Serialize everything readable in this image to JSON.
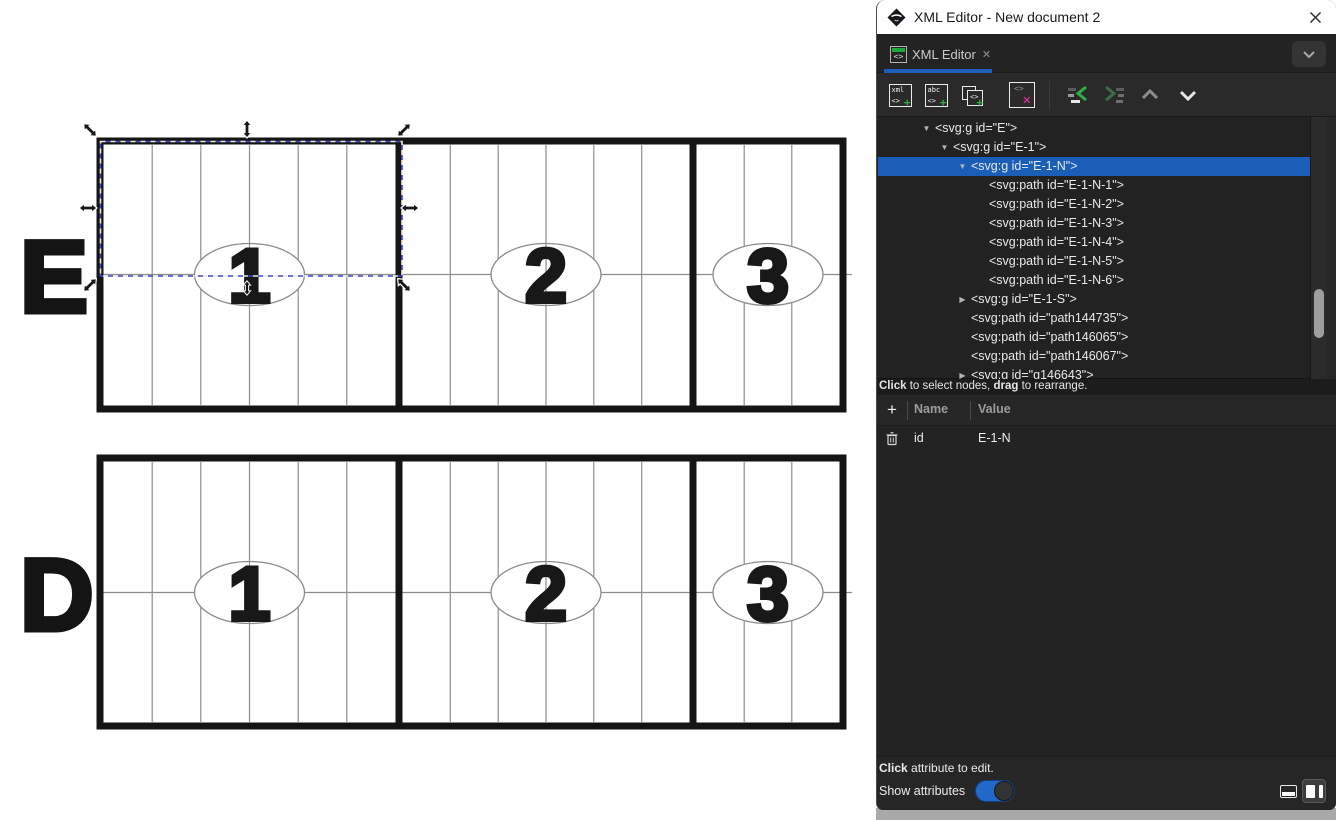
{
  "window": {
    "title": "XML Editor - New document 2"
  },
  "tab": {
    "label": "XML Editor",
    "close_glyph": "✕"
  },
  "icons": {
    "tag": "<>",
    "xml_label": "xml",
    "abc_label": "abc",
    "plus": "+",
    "delete_x": "✕",
    "expander_open": "▼",
    "expander_closed": "▶",
    "add_attribute": "+"
  },
  "xml_tree": {
    "rows": [
      {
        "depth": 0,
        "expander": "open",
        "text": "<svg:g id=\"E\">",
        "selected": false
      },
      {
        "depth": 1,
        "expander": "open",
        "text": "<svg:g id=\"E-1\">",
        "selected": false
      },
      {
        "depth": 2,
        "expander": "open",
        "text": "<svg:g id=\"E-1-N\">",
        "selected": true
      },
      {
        "depth": 3,
        "expander": null,
        "text": "<svg:path id=\"E-1-N-1\">",
        "selected": false
      },
      {
        "depth": 3,
        "expander": null,
        "text": "<svg:path id=\"E-1-N-2\">",
        "selected": false
      },
      {
        "depth": 3,
        "expander": null,
        "text": "<svg:path id=\"E-1-N-3\">",
        "selected": false
      },
      {
        "depth": 3,
        "expander": null,
        "text": "<svg:path id=\"E-1-N-4\">",
        "selected": false
      },
      {
        "depth": 3,
        "expander": null,
        "text": "<svg:path id=\"E-1-N-5\">",
        "selected": false
      },
      {
        "depth": 3,
        "expander": null,
        "text": "<svg:path id=\"E-1-N-6\">",
        "selected": false
      },
      {
        "depth": 2,
        "expander": "closed",
        "text": "<svg:g id=\"E-1-S\">",
        "selected": false
      },
      {
        "depth": 2,
        "expander": null,
        "text": "<svg:path id=\"path144735\">",
        "selected": false
      },
      {
        "depth": 2,
        "expander": null,
        "text": "<svg:path id=\"path146065\">",
        "selected": false
      },
      {
        "depth": 2,
        "expander": null,
        "text": "<svg:path id=\"path146067\">",
        "selected": false
      },
      {
        "depth": 2,
        "expander": "closed",
        "text": "<svg:g id=\"g146643\">",
        "selected": false
      }
    ],
    "hint": {
      "b1": "Click",
      "t1": " to select nodes, ",
      "b2": "drag",
      "t2": " to rearrange."
    }
  },
  "attributes": {
    "columns": [
      "Name",
      "Value"
    ],
    "rows": [
      {
        "name": "id",
        "value": "E-1-N"
      }
    ],
    "hint": {
      "b1": "Click",
      "t1": " attribute to edit."
    },
    "show_label": "Show attributes",
    "show_on": true
  },
  "canvas": {
    "rows": [
      {
        "label": "E",
        "sections": [
          "1",
          "2",
          "3"
        ]
      },
      {
        "label": "D",
        "sections": [
          "1",
          "2",
          "3"
        ]
      }
    ]
  },
  "colors": {
    "selection_row_blue": "#1b5eb8",
    "tab_accent_blue": "#1d5fb8",
    "toggle_blue": "#2268c8",
    "dash_blue": "#3b46c8",
    "icon_green": "#2fae44",
    "icon_magenta": "#f02f9e"
  }
}
